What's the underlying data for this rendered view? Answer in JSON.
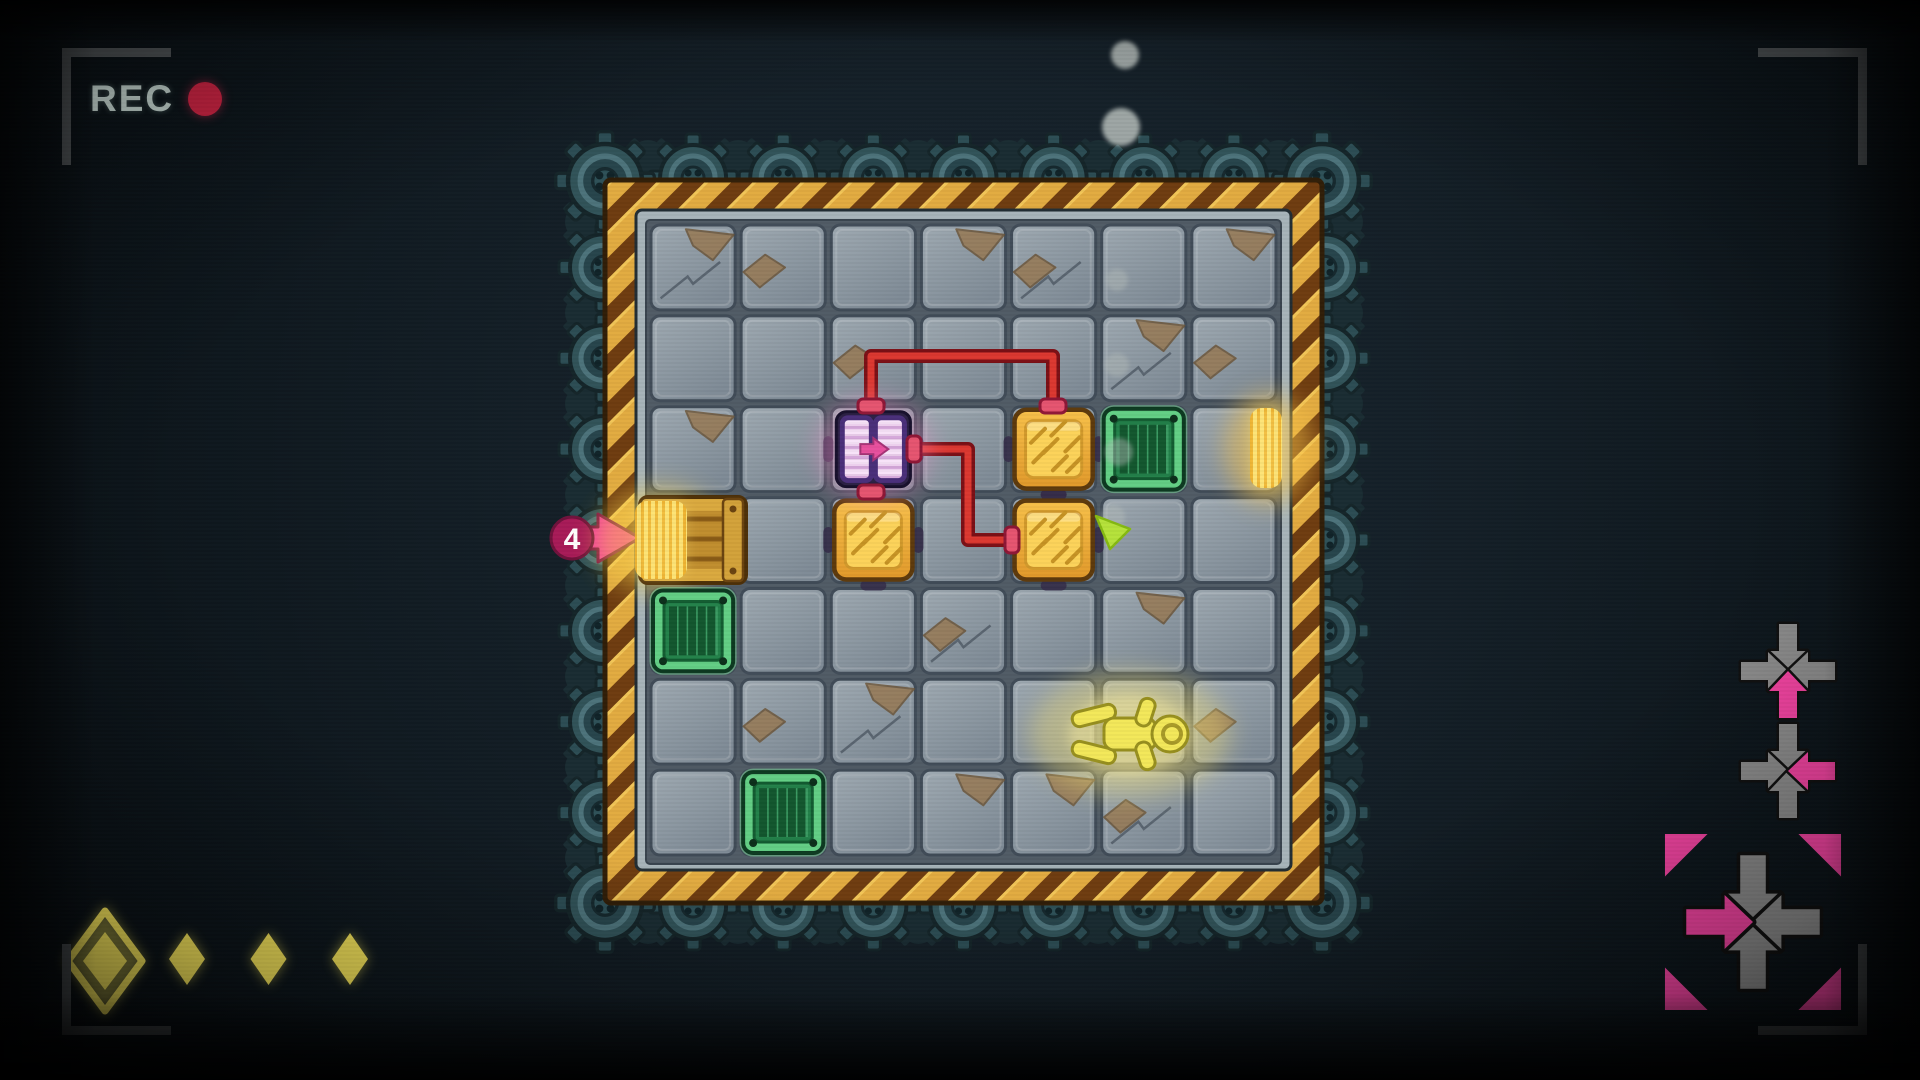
{
  "hud": {
    "rec": {
      "label": "REC",
      "dot_color": "#d62546"
    },
    "collectibles": {
      "icon": "diamond",
      "total": 4,
      "items": [
        {
          "selected": true
        },
        {
          "selected": false
        },
        {
          "selected": false
        },
        {
          "selected": false
        }
      ]
    },
    "input_history": [
      {
        "direction": "up",
        "framed": false
      },
      {
        "direction": "left",
        "framed": false
      },
      {
        "direction": "right",
        "framed": true
      }
    ]
  },
  "board": {
    "grid": {
      "cols": 7,
      "rows": 7,
      "origin_x": 648,
      "origin_y": 222,
      "cell_w": 90.14,
      "cell_h": 90.86
    },
    "entry_arrow": {
      "label": "4",
      "row": 3,
      "side": "left"
    },
    "objects": [
      {
        "type": "wood-crate",
        "col": 0,
        "row": 3,
        "state": "entering"
      },
      {
        "type": "green-crate",
        "col": 0,
        "row": 4
      },
      {
        "type": "green-crate",
        "col": 1,
        "row": 6
      },
      {
        "type": "green-crate",
        "col": 5,
        "row": 2
      },
      {
        "type": "orange-crate",
        "col": 4,
        "row": 2
      },
      {
        "type": "orange-crate",
        "col": 2,
        "row": 3
      },
      {
        "type": "orange-crate",
        "col": 4,
        "row": 3
      },
      {
        "type": "door",
        "col": 2,
        "row": 2,
        "arrow": "right"
      },
      {
        "type": "exit-glow",
        "row": 2,
        "side": "right"
      },
      {
        "type": "player",
        "x": 1130,
        "y": 734,
        "pose": "lying"
      },
      {
        "type": "cursor",
        "x": 1096,
        "y": 516
      }
    ],
    "wires": [
      {
        "from": "door-top",
        "to": "orange-crate-top",
        "points": [
          [
            871,
            404
          ],
          [
            871,
            356
          ],
          [
            1053,
            356
          ],
          [
            1053,
            404
          ]
        ]
      },
      {
        "from": "door-right",
        "to": "orange-crate-left",
        "points": [
          [
            914,
            449
          ],
          [
            968,
            449
          ],
          [
            968,
            540
          ],
          [
            1012,
            540
          ]
        ]
      }
    ],
    "particles": [
      {
        "x": 1125,
        "y": 55,
        "r": 14
      },
      {
        "x": 1121,
        "y": 127,
        "r": 19
      },
      {
        "x": 1117,
        "y": 280,
        "r": 11
      },
      {
        "x": 1117,
        "y": 365,
        "r": 12
      },
      {
        "x": 1119,
        "y": 452,
        "r": 14
      },
      {
        "x": 1113,
        "y": 517,
        "r": 12
      }
    ],
    "chips": [
      [
        0,
        0
      ],
      [
        1,
        0
      ],
      [
        3,
        0
      ],
      [
        4,
        0
      ],
      [
        6,
        0
      ],
      [
        2,
        1
      ],
      [
        5,
        1
      ],
      [
        6,
        1
      ],
      [
        0,
        2
      ],
      [
        3,
        4
      ],
      [
        5,
        4
      ],
      [
        1,
        5
      ],
      [
        2,
        5
      ],
      [
        6,
        5
      ],
      [
        3,
        6
      ],
      [
        5,
        6
      ],
      [
        4,
        6
      ]
    ]
  },
  "colors": {
    "accent_pink": "#f23d9e",
    "wire_red": "#dc3830",
    "hazard_gold": "#e2ab41",
    "hazard_brown": "#6f3d10",
    "gear_teal": "#315359",
    "tile_gray": "#8b96a0",
    "orange_crate": "#f4b83e",
    "green_crate": "#23814a",
    "wood_crate": "#c18e2e",
    "collect_yellow": "#f8e75c",
    "cursor_lime": "#b5e23b",
    "door_purple": "#4a2f7a",
    "rec_dot": "#d62546"
  }
}
